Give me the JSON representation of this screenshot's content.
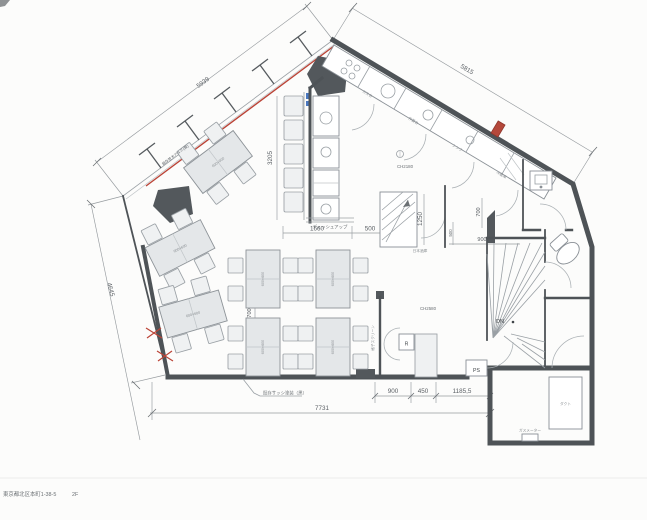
{
  "sheet": {
    "address": "東京都北区本町1-38-5",
    "floor": "2F"
  },
  "dimensions": {
    "wall_top_left": "5939",
    "wall_top_right": "5815",
    "wall_left": "4645",
    "wall_bottom": "7731",
    "counter_length": "3205",
    "counter_depth": "400",
    "kitchen_front": "1660",
    "service_pass": "500",
    "stair_up_width": "1250",
    "corridor_width": "500",
    "lavatory_width": "900",
    "lavatory_depth": "700",
    "entry_span_1": "900",
    "entry_span_2": "450",
    "entry_span_3": "1185,5",
    "table_pitch": "700"
  },
  "ceiling": {
    "kitchen": "CH2180",
    "hall": "CH2580"
  },
  "rooms": {
    "stair_down": "DN",
    "pipe_space": "PS",
    "register": "R",
    "sake_store": "日本酒庫",
    "duct": "ダクト",
    "gas_meter": "ガスメーター"
  },
  "labels": {
    "dish_up": "ディッシュアップ",
    "screen": "格子スクリーン",
    "wall_note": "既存笠木アルミ(仮)",
    "sash_note": "既存サッシ塗装（黒）",
    "table_size": "600×600"
  },
  "kitchen_equipment": [
    "ガス台",
    "作業台",
    "シンク",
    "冷蔵庫"
  ]
}
